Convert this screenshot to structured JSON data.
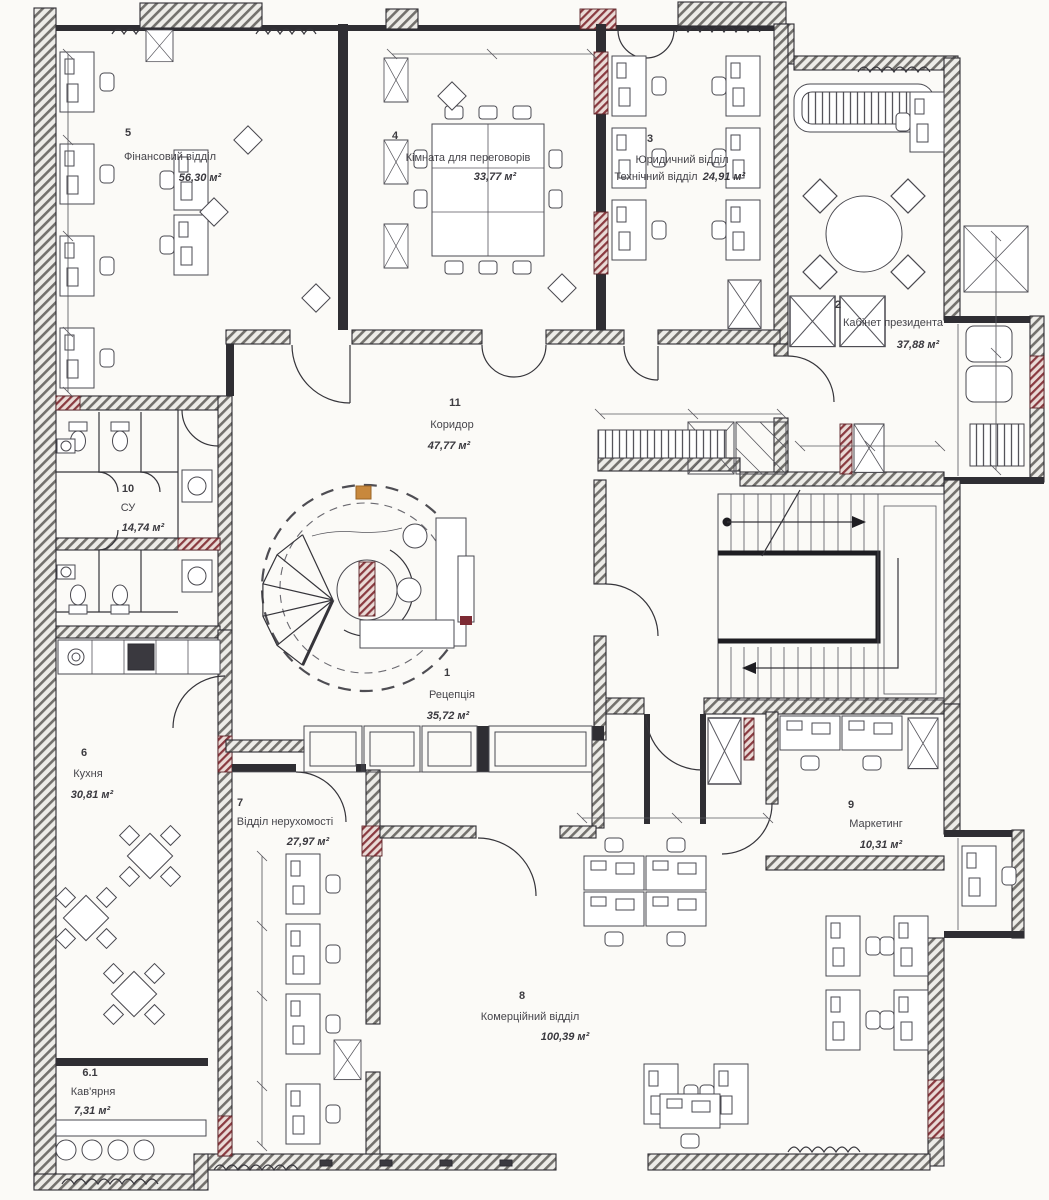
{
  "rooms": {
    "r1": {
      "number": "1",
      "name": "Рецепція",
      "area": "35,72 м²"
    },
    "r2": {
      "number": "2",
      "name": "Кабінет президента",
      "area": "37,88 м²"
    },
    "r3": {
      "number": "3",
      "name": "Юридичний відділ",
      "name2": "Технічний відділ",
      "area": "24,91 м²"
    },
    "r4": {
      "number": "4",
      "name": "Кімната для переговорів",
      "area": "33,77 м²"
    },
    "r5": {
      "number": "5",
      "name": "Фінансовий відділ",
      "area": "56,30 м²"
    },
    "r6": {
      "number": "6",
      "name": "Кухня",
      "area": "30,81 м²"
    },
    "r61": {
      "number": "6.1",
      "name": "Кав'ярня",
      "area": "7,31 м²"
    },
    "r7": {
      "number": "7",
      "name": "Відділ нерухомості",
      "area": "27,97 м²"
    },
    "r8": {
      "number": "8",
      "name": "Комерційний відділ",
      "area": "100,39 м²"
    },
    "r9": {
      "number": "9",
      "name": "Маркетинг",
      "area": "10,31 м²"
    },
    "r10": {
      "number": "10",
      "name": "СУ",
      "area": "14,74 м²"
    },
    "r11": {
      "number": "11",
      "name": "Коридор",
      "area": "47,77 м²"
    }
  },
  "palette": {
    "background": "#fbfaf7",
    "line": "#2e2d33",
    "wall_hatch": "#73716d",
    "wall_hatch_bg": "#edece8",
    "accent_red_hatch": "#8a3a40",
    "accent_orange": "#c8883c",
    "label_text": "#46454b"
  }
}
